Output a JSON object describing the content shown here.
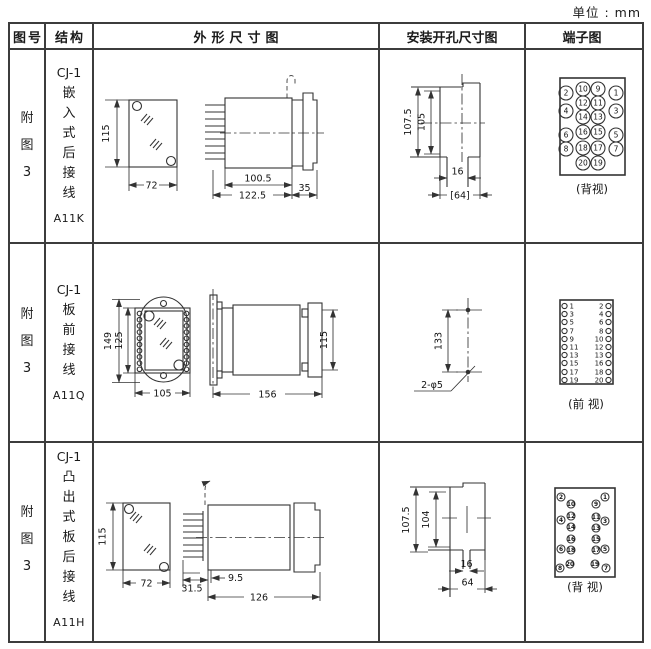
{
  "unit_label": "单位 : mm",
  "header": {
    "fig": "图号",
    "structure": "结构",
    "outline": "外形尺寸图",
    "mounting": "安装开孔尺寸图",
    "terminal": "端子图"
  },
  "rows": [
    {
      "fig": "附图3",
      "model": "CJ-1",
      "structure": "嵌入式后接线",
      "code": "A11K",
      "outline": {
        "front_height": "115",
        "front_width": "72",
        "depth_body": "100.5",
        "depth_total": "122.5",
        "panel_depth": "35"
      },
      "mounting": {
        "outer_height": "107.5",
        "inner_height": "105",
        "slot_width": "16",
        "cutout_width": "[64]"
      },
      "terminal": {
        "view_label": "(背视)",
        "pins": [
          "2",
          "10",
          "9",
          "1",
          "12",
          "11",
          "4",
          "3",
          "14",
          "13",
          "16",
          "15",
          "6",
          "5",
          "18",
          "17",
          "8",
          "7",
          "20",
          "19"
        ]
      }
    },
    {
      "fig": "附图3",
      "model": "CJ-1",
      "structure": "板前接线",
      "code": "A11Q",
      "outline": {
        "plate_height": "149",
        "body_height": "125",
        "front_width": "105",
        "depth": "156",
        "side_height": "115"
      },
      "mounting": {
        "hole_spacing": "133",
        "hole_spec": "2-φ5"
      },
      "terminal": {
        "view_label": "(前 视)",
        "left_pins": [
          "1",
          "3",
          "5",
          "7",
          "9",
          "11",
          "13",
          "15",
          "17",
          "19"
        ],
        "right_pins": [
          "2",
          "4",
          "6",
          "8",
          "10",
          "12",
          "13",
          "16",
          "18",
          "20"
        ]
      }
    },
    {
      "fig": "附图3",
      "model": "CJ-1",
      "structure": "凸出式板后接线",
      "code": "A11H",
      "outline": {
        "front_height": "115",
        "front_width": "72",
        "pin_length": "31.5",
        "step": "9.5",
        "depth": "126"
      },
      "mounting": {
        "outer_height": "107.5",
        "inner_height": "104",
        "slot_width": "16",
        "cutout_width": "64"
      },
      "terminal": {
        "view_label": "(背 视)",
        "pins": [
          "2",
          "1",
          "10",
          "9",
          "12",
          "11",
          "4",
          "3",
          "14",
          "13",
          "16",
          "15",
          "6",
          "18",
          "17",
          "5",
          "20",
          "19",
          "8",
          "7"
        ]
      }
    }
  ]
}
